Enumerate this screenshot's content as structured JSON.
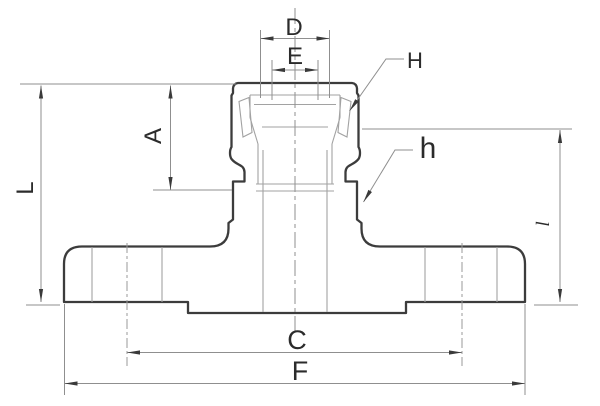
{
  "drawing": {
    "kind": "engineering-dimension-drawing",
    "subject": "flanged cam-and-groove coupler, front view",
    "background": "#ffffff",
    "colors": {
      "outline": "#3c3c3c",
      "thin_line": "#a2a2a2",
      "dimension_line": "#8f8f8f",
      "arrowhead": "#3a3a3a",
      "label": "#2b2b2b"
    },
    "labels": {
      "D": "D",
      "E": "E",
      "H": "H",
      "h": "h",
      "A": "A",
      "L": "L",
      "l": "l",
      "C": "C",
      "F": "F"
    }
  }
}
